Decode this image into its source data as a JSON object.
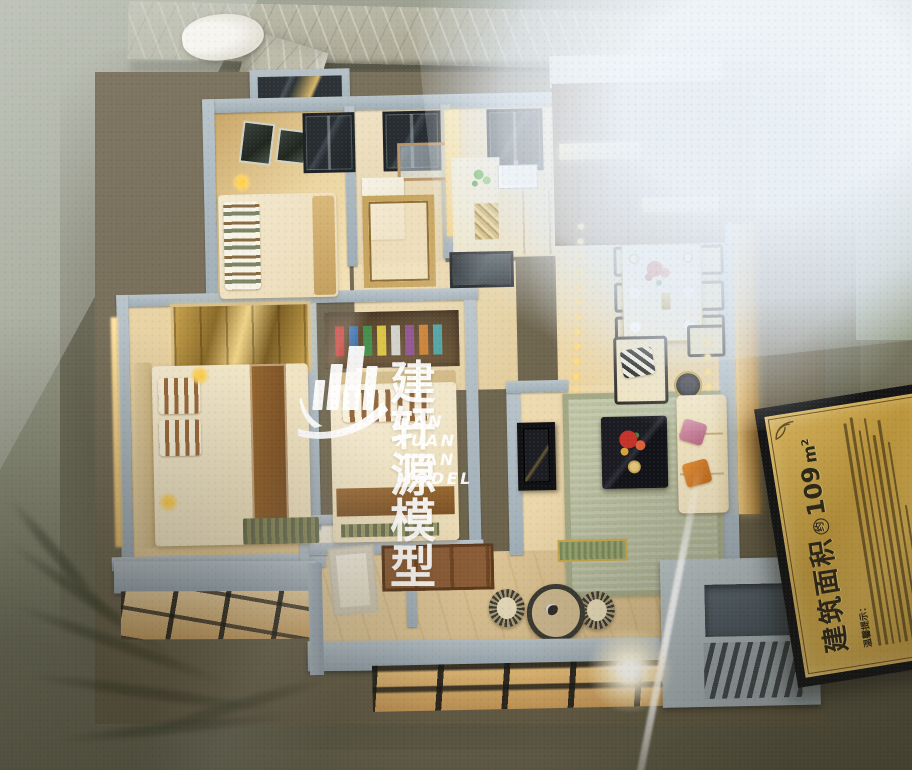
{
  "scene": {
    "subject": "glass-cased architectural scale model of an apartment floor plan"
  },
  "watermark": {
    "brand_cn": "建轩源模型",
    "brand_en": "JIAN XUAN YUAN MODEL",
    "logo": "buildings-swoosh-logo-icon",
    "color": "#ffffff"
  },
  "plaque": {
    "area_label_prefix": "建筑面积",
    "area_approx_mark": "约",
    "area_value": "109",
    "area_unit": "m²",
    "tips_heading": "温馨提示：",
    "plate_color": "#c9a64a",
    "frame_color": "#141414",
    "text_color": "#2e2817"
  },
  "palette": {
    "display_base": "#7a7b63",
    "marble_frame": "#b2b09c",
    "model_walls": "#a9b6bd",
    "warm_floor": "#ecd9ae",
    "wood_cabinet": "#7b5836",
    "led_gold": "#ffdb80",
    "rug_green": "#b6bc9c",
    "flower_red": "#c5322a",
    "glare_white": "#fffef8"
  }
}
